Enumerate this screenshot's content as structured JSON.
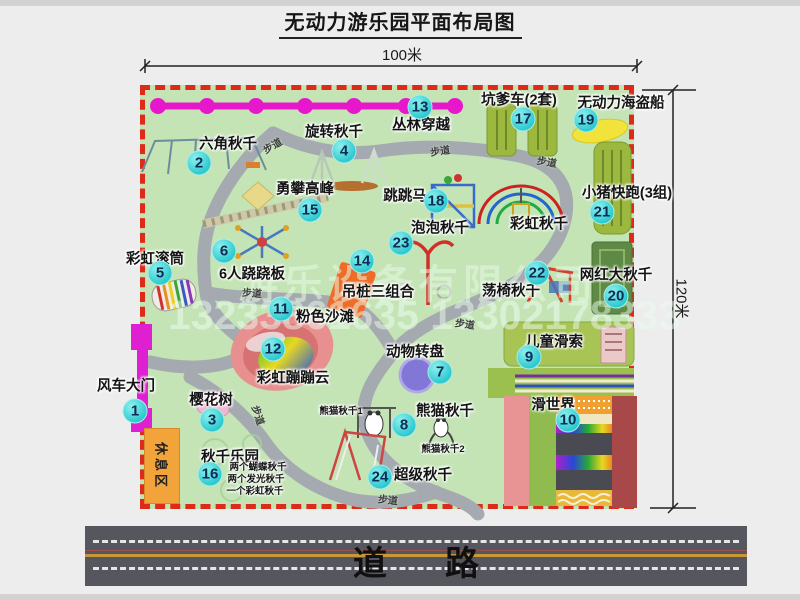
{
  "title": "无动力游乐园平面布局图",
  "dimensions": {
    "width_label": "100米",
    "height_label": "120米"
  },
  "road": {
    "label": "道路"
  },
  "watermark": {
    "company": "游乐设备有限公司",
    "phone": "13233861635 13302178333"
  },
  "park": {
    "rest_area_label": "休息区",
    "items": [
      {
        "num": 1,
        "label": "风车大门",
        "label_pos": [
          126,
          385
        ],
        "circle_pos": [
          135,
          411
        ]
      },
      {
        "num": 2,
        "label": "六角秋千",
        "label_pos": [
          228,
          143
        ],
        "circle_pos": [
          199,
          163
        ]
      },
      {
        "num": 3,
        "label": "樱花树",
        "label_pos": [
          211,
          399
        ],
        "circle_pos": [
          212,
          420
        ]
      },
      {
        "num": 4,
        "label": "旋转秋千",
        "label_pos": [
          334,
          131
        ],
        "circle_pos": [
          344,
          151
        ]
      },
      {
        "num": 5,
        "label": "彩虹滚筒",
        "label_pos": [
          155,
          258
        ],
        "circle_pos": [
          160,
          273
        ]
      },
      {
        "num": 6,
        "label": "6人跷跷板",
        "label_pos": [
          252,
          273
        ],
        "circle_pos": [
          224,
          251
        ]
      },
      {
        "num": 7,
        "label": "动物转盘",
        "label_pos": [
          415,
          351
        ],
        "circle_pos": [
          440,
          372
        ]
      },
      {
        "num": 8,
        "label": "熊猫秋千",
        "label_pos": [
          445,
          410
        ],
        "circle_pos": [
          404,
          425
        ]
      },
      {
        "num": 9,
        "label": "儿童滑索",
        "label_pos": [
          554,
          341
        ],
        "circle_pos": [
          529,
          357
        ]
      },
      {
        "num": 10,
        "label": "滑世界",
        "label_pos": [
          553,
          404
        ],
        "circle_pos": [
          568,
          420
        ]
      },
      {
        "num": 11,
        "label": "粉色沙滩",
        "label_pos": [
          325,
          316
        ],
        "circle_pos": [
          281,
          309
        ]
      },
      {
        "num": 12,
        "label": "彩虹蹦蹦云",
        "label_pos": [
          293,
          377
        ],
        "circle_pos": [
          273,
          349
        ]
      },
      {
        "num": 13,
        "label": "丛林穿越",
        "label_pos": [
          421,
          124
        ],
        "circle_pos": [
          420,
          107
        ]
      },
      {
        "num": 14,
        "label": "吊桩三组合",
        "label_pos": [
          378,
          291
        ],
        "circle_pos": [
          362,
          261
        ]
      },
      {
        "num": 15,
        "label": "勇攀高峰",
        "label_pos": [
          305,
          188
        ],
        "circle_pos": [
          310,
          210
        ]
      },
      {
        "num": 16,
        "label": "秋千乐园",
        "label_pos": [
          230,
          456
        ],
        "circle_pos": [
          210,
          474
        ]
      },
      {
        "num": 17,
        "label": "坑爹车(2套)",
        "label_pos": [
          519,
          99
        ],
        "circle_pos": [
          523,
          119
        ]
      },
      {
        "num": 18,
        "label": "跳跳马",
        "label_pos": [
          405,
          195
        ],
        "circle_pos": [
          436,
          201
        ]
      },
      {
        "num": 19,
        "label": "无动力海盗船",
        "label_pos": [
          621,
          102
        ],
        "circle_pos": [
          586,
          120
        ]
      },
      {
        "num": 20,
        "label": "网红大秋千",
        "label_pos": [
          616,
          274
        ],
        "circle_pos": [
          616,
          296
        ]
      },
      {
        "num": 21,
        "label": "小猪快跑(3组)",
        "label_pos": [
          627,
          192
        ],
        "circle_pos": [
          602,
          212
        ]
      },
      {
        "num": 22,
        "label": "荡椅秋千",
        "label_pos": [
          511,
          290
        ],
        "circle_pos": [
          537,
          273
        ]
      },
      {
        "num": 23,
        "label": "泡泡秋千",
        "label_pos": [
          440,
          227
        ],
        "circle_pos": [
          401,
          243
        ]
      },
      {
        "num": 24,
        "label": "超级秋千",
        "label_pos": [
          423,
          474
        ],
        "circle_pos": [
          380,
          477
        ]
      }
    ],
    "extra_labels": [
      {
        "label": "彩虹秋千",
        "pos": [
          539,
          223
        ],
        "small": false
      },
      {
        "label": "熊猫秋千1",
        "pos": [
          341,
          410
        ],
        "small": true
      },
      {
        "label": "熊猫秋千2",
        "pos": [
          443,
          448
        ],
        "small": true
      },
      {
        "label": "两个蝴蝶秋千",
        "pos": [
          258,
          466
        ],
        "small": true
      },
      {
        "label": "两个发光秋千",
        "pos": [
          256,
          478
        ],
        "small": true
      },
      {
        "label": "一个彩虹秋千",
        "pos": [
          255,
          490
        ],
        "small": true
      }
    ],
    "path_labels": [
      {
        "label": "步道",
        "pos": [
          272,
          145
        ],
        "rot": -30
      },
      {
        "label": "步道",
        "pos": [
          440,
          150
        ],
        "rot": -8
      },
      {
        "label": "步道",
        "pos": [
          547,
          161
        ],
        "rot": 10
      },
      {
        "label": "步道",
        "pos": [
          252,
          292
        ],
        "rot": 4
      },
      {
        "label": "步道",
        "pos": [
          465,
          323
        ],
        "rot": 8
      },
      {
        "label": "步道",
        "pos": [
          259,
          415
        ],
        "rot": 72
      },
      {
        "label": "步道",
        "pos": [
          388,
          499
        ],
        "rot": 6
      }
    ]
  },
  "colors": {
    "park_green": "#c4e4b6",
    "border_red": "#de2a18",
    "path_gray": "#a5aab0",
    "pink_line": "#e718cb",
    "circle_cyan": "#2cc9cf",
    "gate_magenta": "#df1fd2",
    "rest_orange": "#f2a33a",
    "road_gray": "#56565e"
  }
}
